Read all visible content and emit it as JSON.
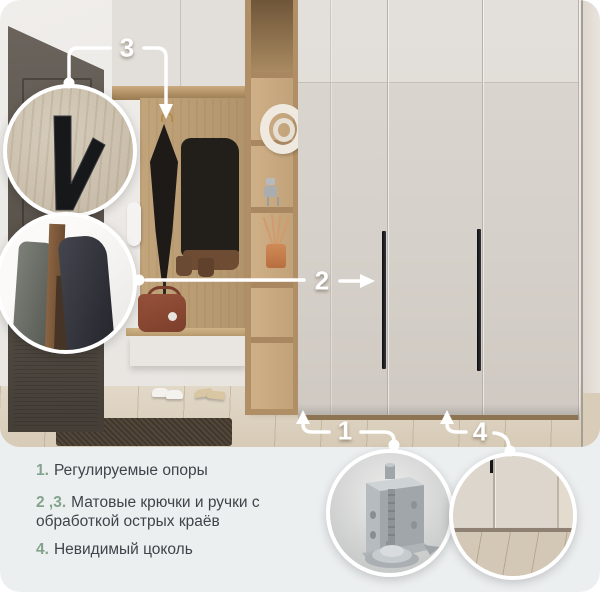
{
  "card_type": "furniture-feature-infographic",
  "colors": {
    "accent_green": "#83a38d",
    "legend_text": "#3e4449",
    "panel_bg": "#eceff0",
    "annotation": "#ffffff"
  },
  "callouts": {
    "n1": "1",
    "n2": "2",
    "n3": "3",
    "n4": "4"
  },
  "legend": {
    "items": [
      {
        "num": "1.",
        "text": "Регулируемые опоры"
      },
      {
        "num": "2 ,3.",
        "text": "Матовые крючки и ручки с обработкой острых краёв"
      },
      {
        "num": "4.",
        "text": "Невидимый цоколь"
      }
    ]
  },
  "insets": {
    "hook": "matte-black-wall-hook-closeup",
    "edges": "panel-edge-treatment-closeup",
    "foot": "adjustable-support-foot-closeup",
    "plinth": "invisible-plinth-closeup"
  },
  "scene": {
    "description": "hallway with dark entrance door, open oak coat niche with bench, tall shelving column and cream wardrobe with slim black handles"
  }
}
